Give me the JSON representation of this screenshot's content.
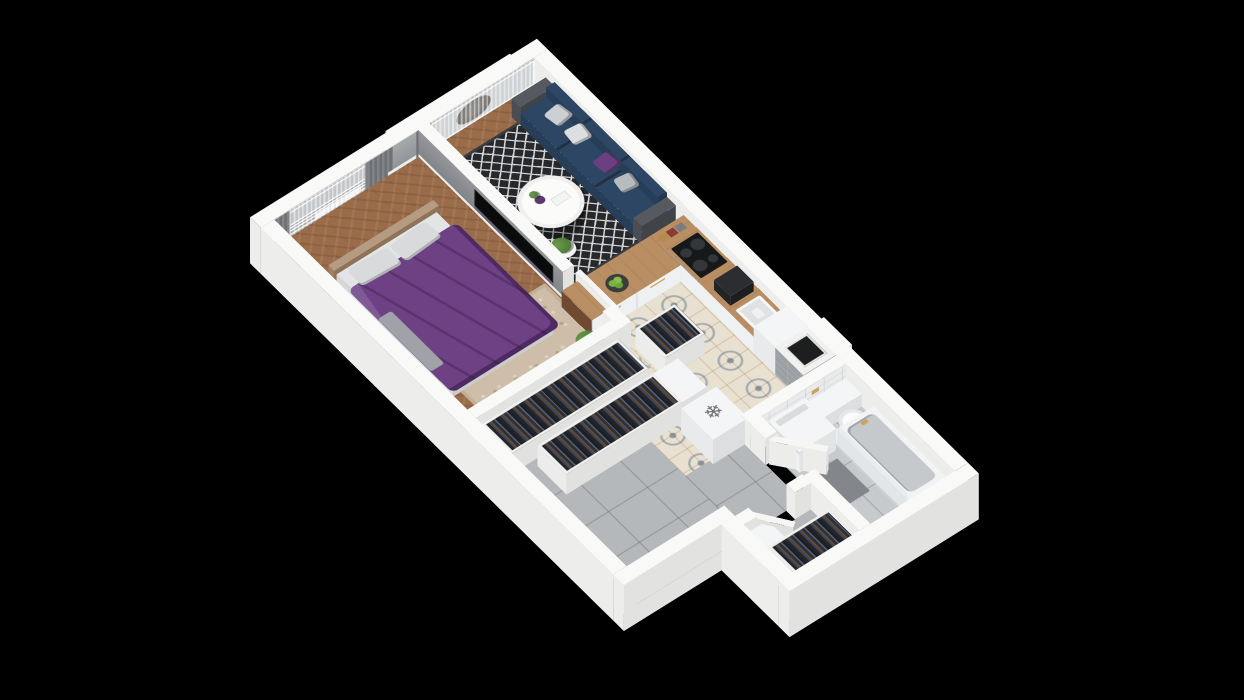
{
  "scene": {
    "view": "isometric-3d-apartment-floor-plan",
    "background": "#000000"
  },
  "colors": {
    "background": "#000000",
    "wall_top": "#f9f9f7",
    "wall_outer": "#ededeb",
    "floor_wood": "#9b6c4a",
    "tile_pattern_base": "#e8e0d0",
    "tile_gray": "#b5b8ba",
    "bath_floor": "#c7cacc",
    "rug_living_base": "#26282b",
    "rug_living_lattice": "#d8d8d8",
    "rug_bedroom": "#cdbda9",
    "sofa_navy": "#2c4663",
    "pillow_purple": "#6c4080",
    "bed_purple": "#6e4185",
    "wood_counter": "#b98e63",
    "wood_dark": "#6f4a30",
    "cabinet_white": "#eef0f1",
    "appliance_white": "#f4f5f6",
    "gold": "#c9a45a",
    "tv_black": "#0a0b0c",
    "clothes_dark": "#23252a",
    "towel_blue": "#3e6da5",
    "plant_green": "#4f7d3a",
    "washer_door": "#4e6d96",
    "chevron_tile": "#b0b3b5",
    "shaft_tile": "#9aa0a3",
    "clock_ring": "#2c2e30",
    "curtain_gray": "#6e7173"
  },
  "rooms": [
    {
      "name": "bedroom",
      "items": [
        "double-bed",
        "purple-duvet",
        "two-pillows",
        "headboard",
        "beige-rug",
        "window-with-curtains",
        "bench",
        "plant",
        "door",
        "tv-on-divider-wall"
      ]
    },
    {
      "name": "living-room",
      "items": [
        "navy-sofa",
        "throw-pillows",
        "round-coffee-table",
        "vase",
        "plant-stand",
        "diamond-pattern-rug",
        "gallery-wall-five-frames",
        "wall-clock",
        "balcony-window",
        "hanging-chair",
        "sheer-curtains",
        "glass-partition"
      ]
    },
    {
      "name": "kitchen",
      "items": [
        "l-shaped-counter",
        "wood-countertop",
        "upper-cabinets",
        "oven",
        "cooktop",
        "sink",
        "coffee-machine",
        "fruit-bowl",
        "spice-jars",
        "fridge-with-snowflake-mark",
        "patterned-tile-floor",
        "ventilation-shaft"
      ]
    },
    {
      "name": "hallway",
      "items": [
        "open-wardrobe-row-1",
        "open-wardrobe-row-2",
        "small-open-wardrobe",
        "drawer-cabinet",
        "gray-tile-floor"
      ]
    },
    {
      "name": "entry-vestibule",
      "items": [
        "entry-door",
        "open-wardrobe-with-clothes",
        "shoe-cabinet"
      ]
    },
    {
      "name": "bathroom",
      "items": [
        "washing-machine",
        "wall-hung-toilet",
        "bathtub",
        "shower-glass",
        "blue-towel",
        "gold-fixtures",
        "chevron-tile-wall",
        "bath-mat",
        "door"
      ]
    }
  ],
  "icons": {
    "snowflake_glyph": "❄"
  }
}
